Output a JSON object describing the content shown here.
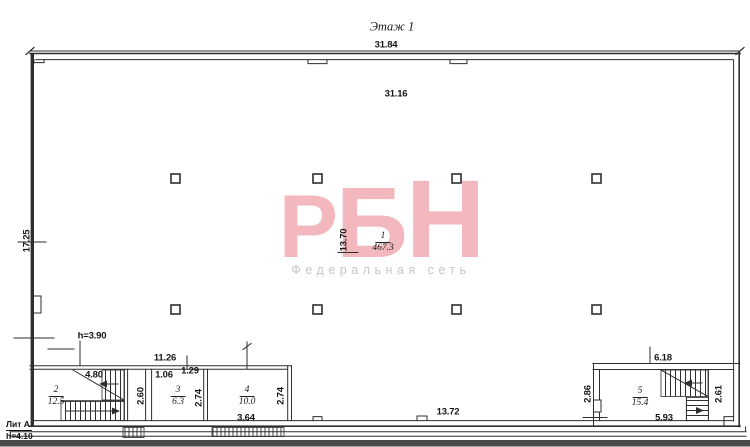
{
  "title": "Этаж 1",
  "watermark": {
    "letters": [
      "Р",
      "Б",
      "Н"
    ],
    "subtitle": "Федеральная сеть",
    "logo_color": "#f2b8be",
    "subtitle_color": "#c6c6c6"
  },
  "labels": {
    "lit": "Лит А",
    "building_height": "h=4.10",
    "interior_height": "h=3.90"
  },
  "rooms": [
    {
      "number": "1",
      "area": "467.3"
    },
    {
      "number": "2",
      "area": "12.5"
    },
    {
      "number": "3",
      "area": "6.3"
    },
    {
      "number": "4",
      "area": "10.0"
    },
    {
      "number": "5",
      "area": "15.4"
    }
  ],
  "dims": {
    "overall_width": "31.84",
    "interior_width": "31.16",
    "overall_height": "17.25",
    "hall_height": "13.70",
    "hall_bottom_width": "13.72",
    "rooms_block_width": "11.26",
    "stair_flight": "4.80",
    "lobby_height": "2.60",
    "room3_offset_left": "1.06",
    "room3_offset_right": "1.29",
    "room3_height": "2.74",
    "room4_height": "2.74",
    "room4_width": "3.64",
    "room5_top_width": "6.18",
    "room5_left_height": "2.86",
    "room5_right_height": "2.61",
    "room5_bottom_width": "5.93"
  },
  "line_color": "#2e2e2e"
}
